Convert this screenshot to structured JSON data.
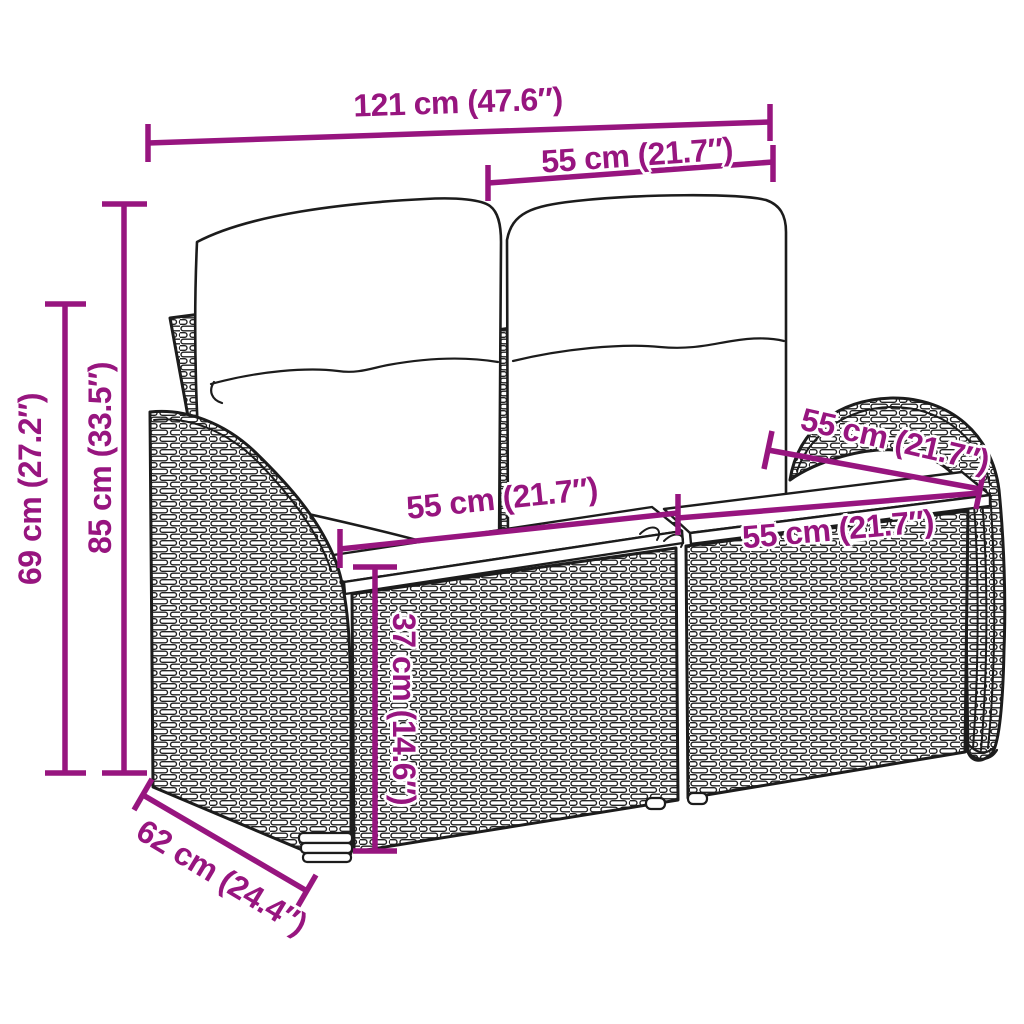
{
  "accent": "#97157F",
  "diagram": {
    "subject": "two-seater rattan garden sofa with cushions (line drawing)",
    "dimensions": {
      "total_width": "121 cm (47.6″)",
      "back_width": "55 cm (21.7″)",
      "total_height": "85 cm (33.5″)",
      "armrest_height": "69 cm (27.2″)",
      "seat_width_left": "55 cm (21.7″)",
      "seat_width_right": "55 cm (21.7″)",
      "seat_depth": "55 cm (21.7″)",
      "seat_height": "37 cm (14.6″)",
      "total_depth": "62 cm (24.4″)"
    }
  }
}
